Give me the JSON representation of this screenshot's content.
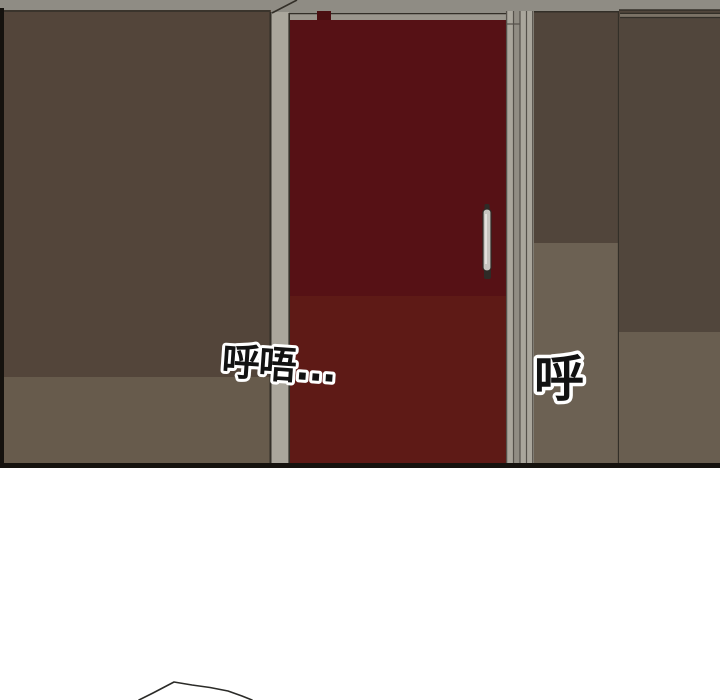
{
  "scene": {
    "sfx": {
      "breath_left": "呼唔...",
      "breath_right": "呼"
    },
    "colors": {
      "background": "#ffffff",
      "outline": "#15120e",
      "seam_line": "#332f28",
      "ceiling": "#8f8c84",
      "track": "#9b978e",
      "notch": "#4b0f11",
      "wall_left_upper": "#53453a",
      "wall_left_lower": "#675b4c",
      "frame_light": "#aaa69c",
      "frame_mid": "#918d84",
      "frame_line": "#55514a",
      "door_upper": "#561115",
      "door_lower": "#5e1a16",
      "handle_metal": "#c6c4bf",
      "handle_dark": "#2e2b27",
      "handle_highlight": "#efede8",
      "wall_mid_upper": "#51453b",
      "wall_mid_lower": "#6c6153",
      "wall_right_upper": "#51463c",
      "wall_right_lower": "#695e50",
      "rail_band": "#7b7266",
      "sfx_fill": "#121212",
      "sfx_halo": "#ffffff",
      "sketch_line": "#2b2b28"
    }
  }
}
